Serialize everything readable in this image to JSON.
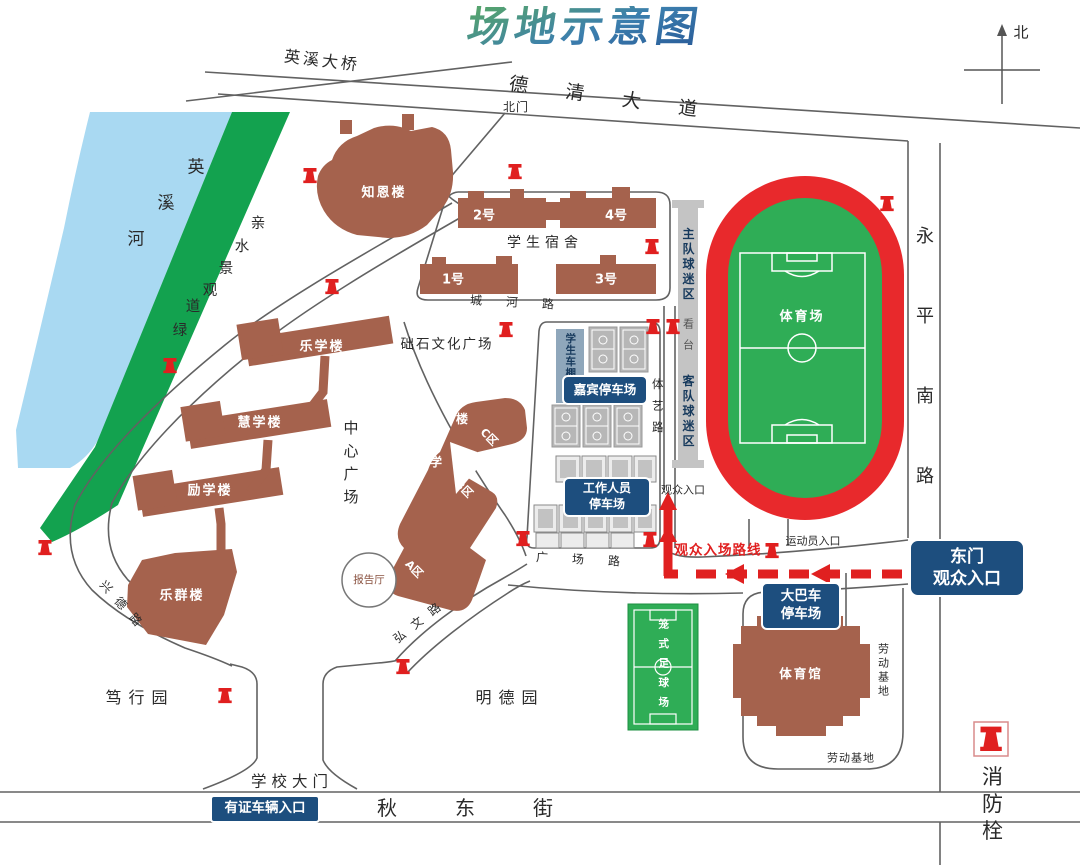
{
  "title": "场地示意图",
  "compass": {
    "north": "北"
  },
  "legend": {
    "fire_hydrant": "消防栓"
  },
  "icons": {
    "fire_hydrant": "red hydrant marker",
    "north_arrow": "cross with up arrow"
  },
  "colors": {
    "badge_blue": "#1d4e7e",
    "route_red": "#e02020",
    "track_red": "#e8292c",
    "field_green": "#2fad56",
    "building_brown": "#a5624d",
    "river_blue": "#a9d9f2",
    "greenway_green": "#13a24f",
    "court_gray": "#b7b7b7"
  },
  "roads": {
    "yingxi_bridge": "英溪大桥",
    "deqing_avenue": "德清大道",
    "north_gate": "北门",
    "yongping_south_road": "永平南路",
    "chenghe_road": "城河路",
    "tiyi_road": "体艺路",
    "guangchang_road": "广场路",
    "hongwen_road": "弘文路",
    "xingde_road": "兴德路",
    "qianqiu_east_street": "千秋东街",
    "school_gate": "学校大门"
  },
  "water": {
    "river_chars": [
      "英",
      "溪",
      "河"
    ],
    "greenway_chars": [
      "亲",
      "水",
      "景",
      "观",
      "道",
      "绿"
    ]
  },
  "buildings": {
    "zhien": "知恩楼",
    "dorm_label": "学生宿舍",
    "dorm1": "1号",
    "dorm2": "2号",
    "dorm3": "3号",
    "dorm4": "4号",
    "lexue": "乐学楼",
    "huixue": "慧学楼",
    "lixue": "励学楼",
    "lequn": "乐群楼",
    "central_plaza": "中心广场",
    "chushi_plaza": "础石文化广场",
    "bo": "博",
    "xue": "学",
    "lou": "楼",
    "zone_a": "A区",
    "zone_b": "B区",
    "zone_c": "C区",
    "lecture_hall": "报告厅",
    "stadium": "体育场",
    "gymnasium": "体育馆",
    "caged_pitch": "笼式足球场",
    "student_shed": "学生车棚"
  },
  "zones": {
    "home_fans": "主队球迷区",
    "grandstand": "看台",
    "away_fans": "客队球迷区",
    "labor_base_right": "劳动基地",
    "labor_base_bottom": "劳动基地",
    "duxing_garden": "笃行园",
    "mingde_garden": "明德园"
  },
  "parking": {
    "vip": "嘉宾停车场",
    "staff_line1": "工作人员",
    "staff_line2": "停车场",
    "bus_line1": "大巴车",
    "bus_line2": "停车场"
  },
  "entrances": {
    "spectator_entrance": "观众入口",
    "athlete_entrance": "运动员入口",
    "route_label": "观众入场路线",
    "east_gate_line1": "东门",
    "east_gate_line2": "观众入口",
    "permit_vehicle": "有证车辆入口"
  }
}
